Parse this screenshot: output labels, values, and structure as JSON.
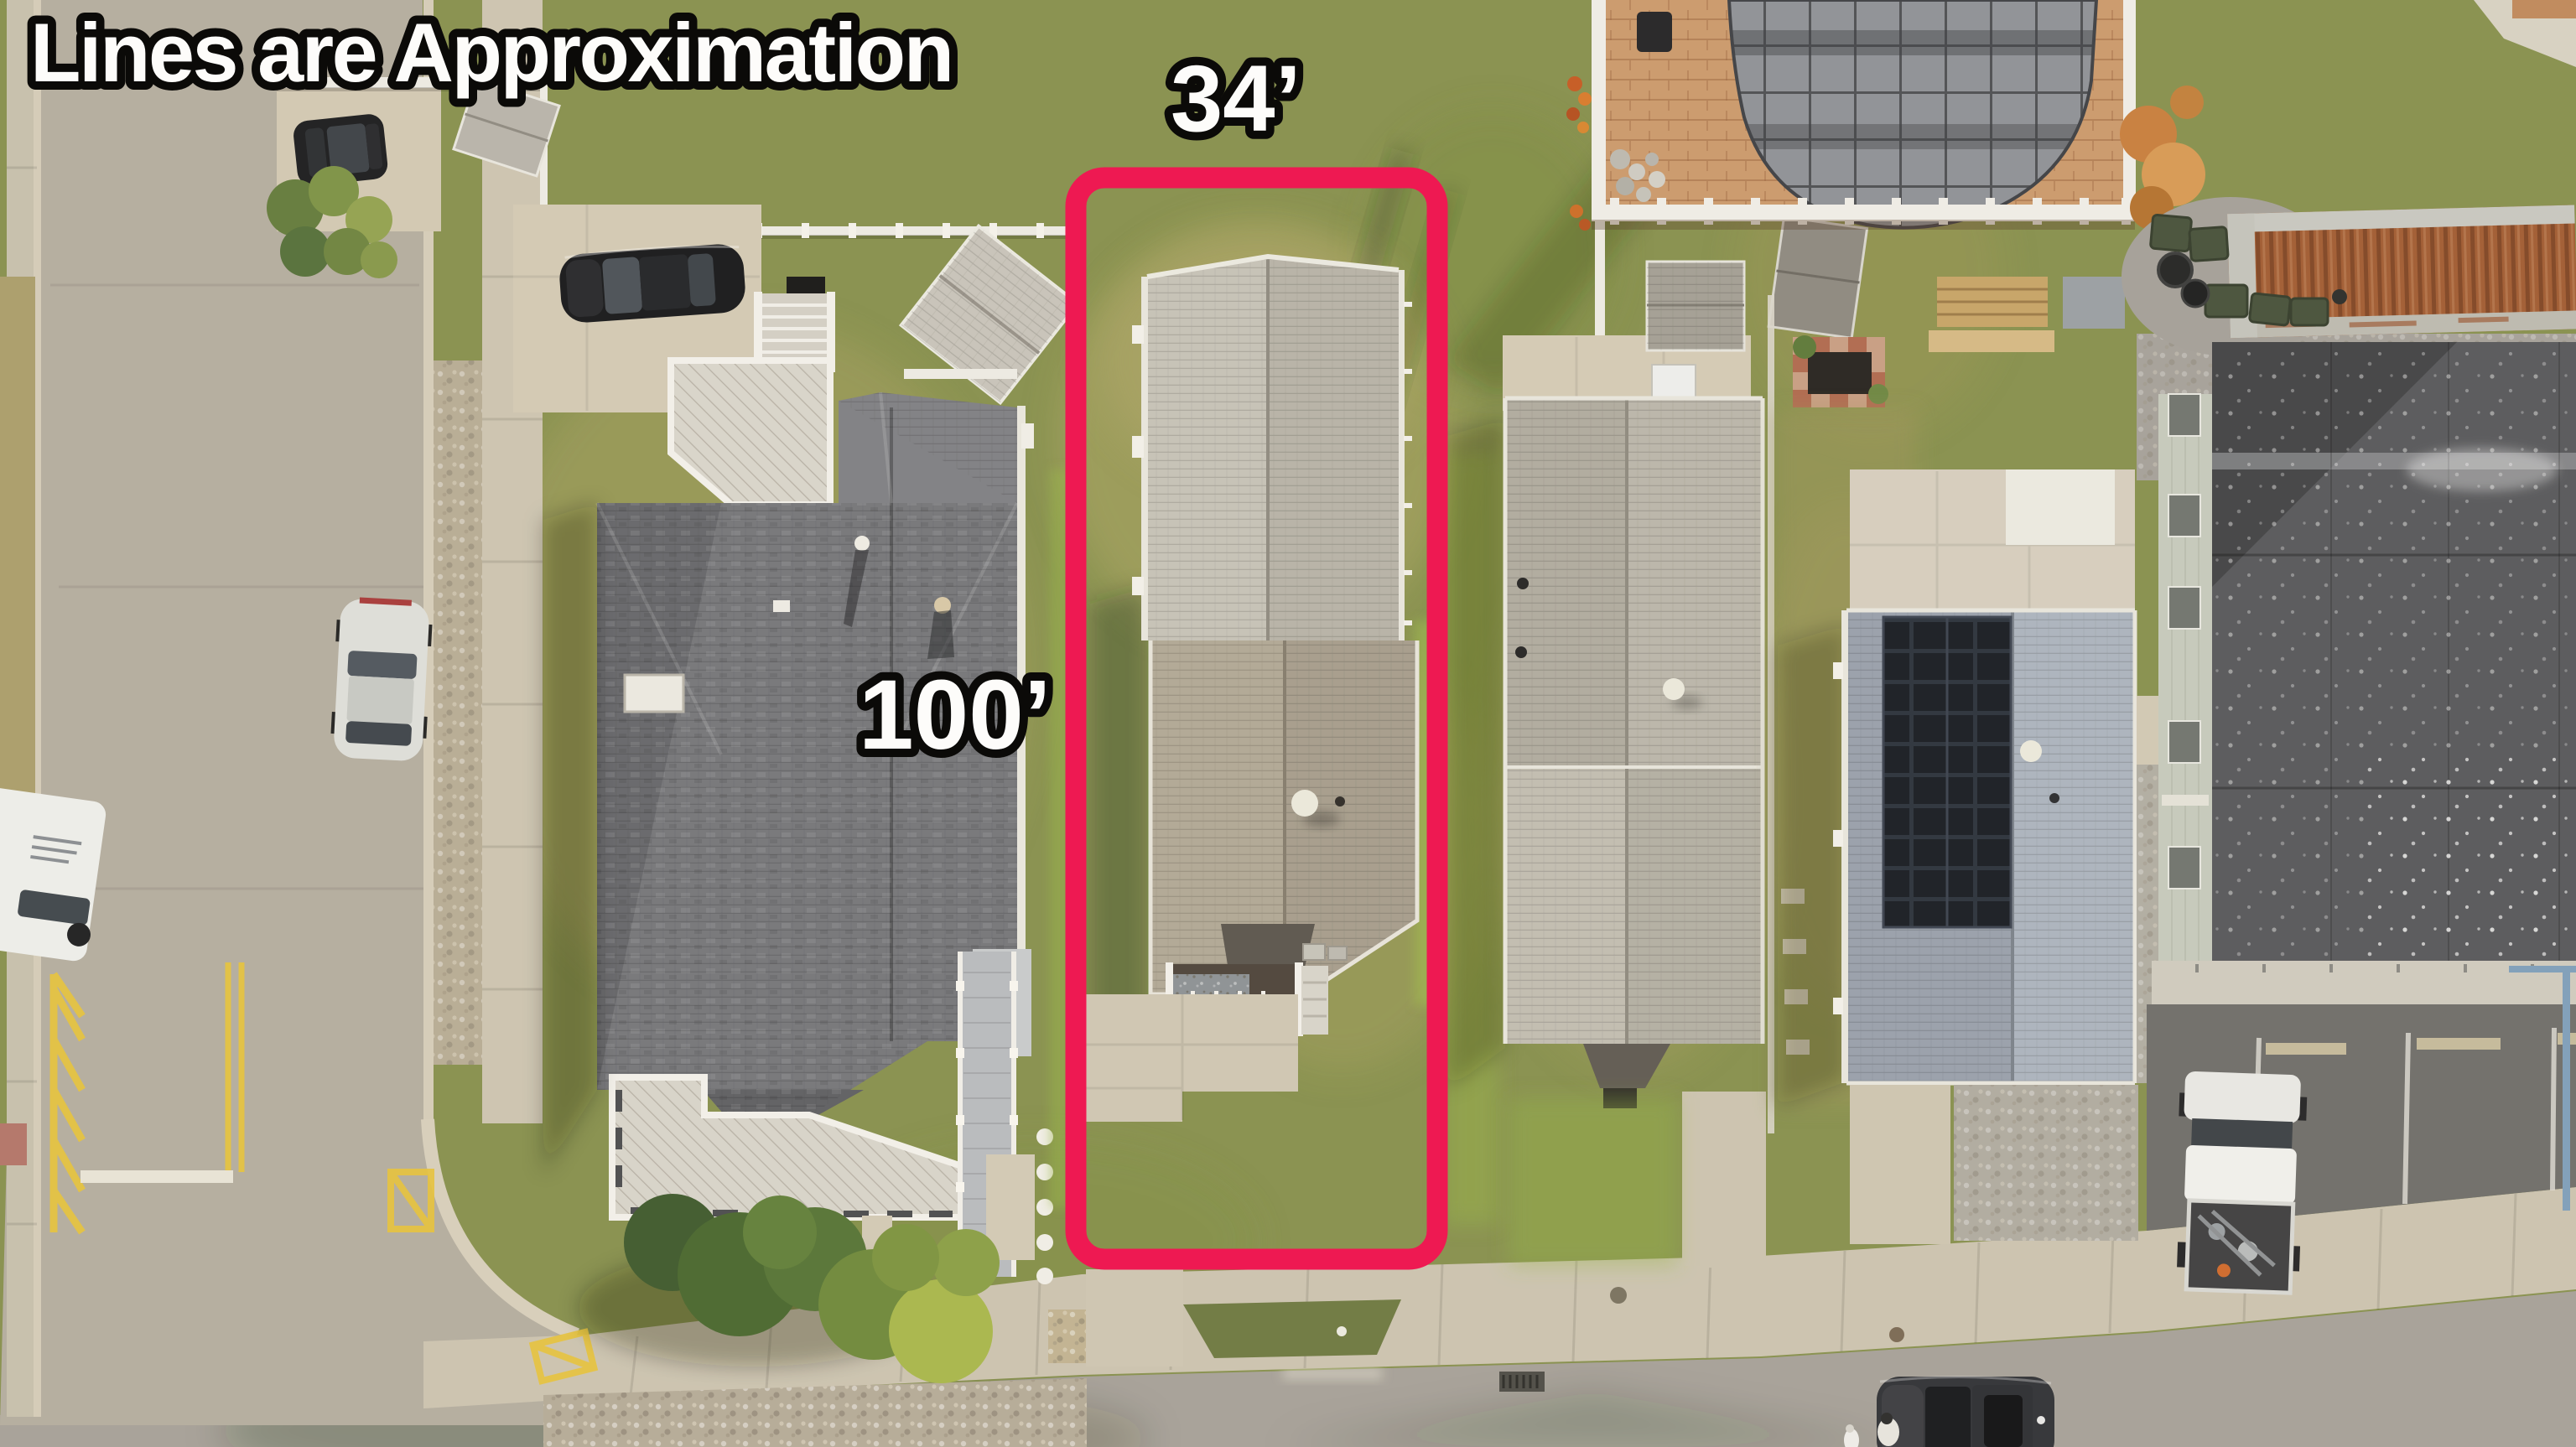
{
  "annotations": {
    "disclaimer": "Lines are Approximation",
    "lot_width_label": "34’",
    "lot_depth_label": "100’"
  },
  "colors": {
    "boundary": "#F0104E",
    "label_fill": "#FFFFFF",
    "label_outline": "#000000"
  },
  "scene": {
    "type": "aerial-drone-photo",
    "subject": "outlined-residential-lot",
    "objects": [
      "vertical-street",
      "bottom-street",
      "sidewalks",
      "yellow-road-markings",
      "large-house-west",
      "subject-house",
      "house-east",
      "solar-house",
      "covered-pool-patio",
      "storage-container",
      "commercial-flat-roof-building",
      "parking-lot",
      "white-pickup-truck",
      "silver-car",
      "black-car",
      "white-van",
      "dark-suv",
      "pedestrian",
      "dog",
      "sheds",
      "garden-bed",
      "trees-bushes"
    ]
  }
}
